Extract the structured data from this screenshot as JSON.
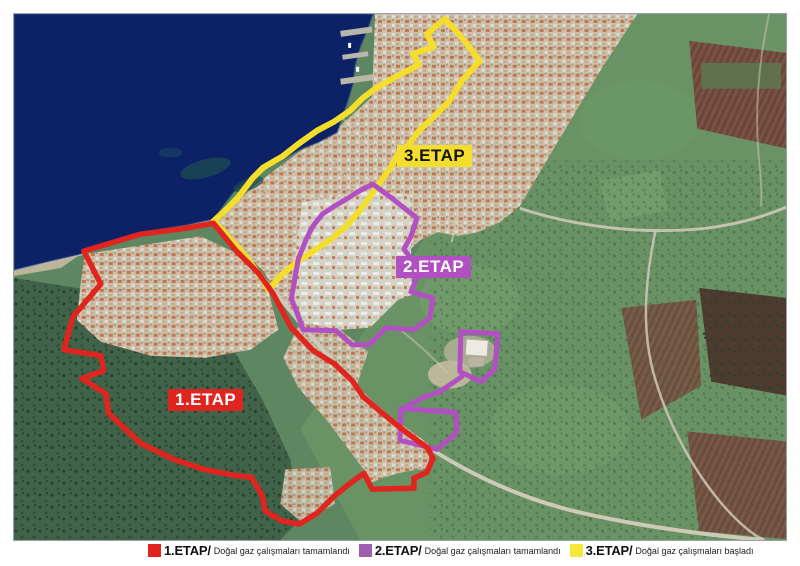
{
  "map": {
    "labels": [
      {
        "id": "etap1",
        "text": "1.ETAP"
      },
      {
        "id": "etap2",
        "text": "2.ETAP"
      },
      {
        "id": "etap3",
        "text": "3.ETAP"
      }
    ]
  },
  "legend": {
    "items": [
      {
        "label": "1.ETAP/",
        "description": "Doğal gaz çalışmaları tamamlandı",
        "swatch_color": "#e0251f"
      },
      {
        "label": "2.ETAP/",
        "description": "Doğal gaz çalışmaları tamamlandı",
        "swatch_color": "#9d5fae"
      },
      {
        "label": "3.ETAP/",
        "description": "Doğal gaz çalışmaları başladı",
        "swatch_color": "#f7e63a"
      }
    ]
  },
  "colors": {
    "etap1": "#e0251f",
    "etap2": "#b24fc2",
    "etap3": "#f4dd2b",
    "legend2": "#9d5fae",
    "legend3": "#f7e63a",
    "water": "#0c2166"
  }
}
